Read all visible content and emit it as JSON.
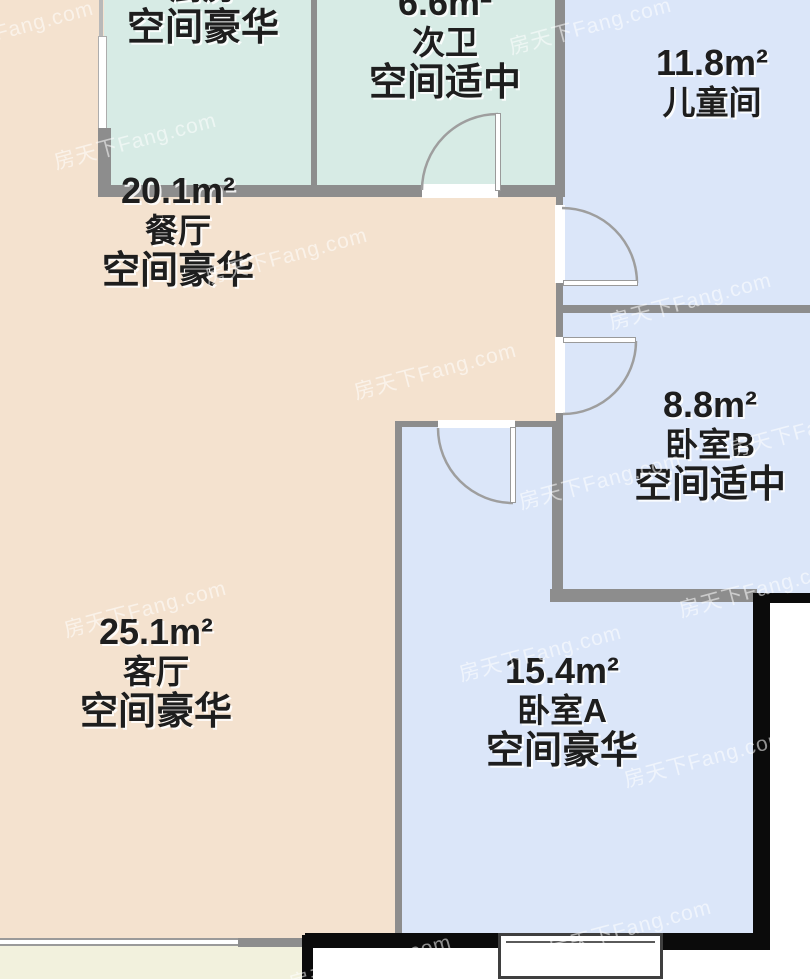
{
  "watermark": {
    "text": "房天下Fang.com"
  },
  "rooms": [
    {
      "id": "kitchen",
      "area": "",
      "name": "厨房",
      "quality": "空间豪华",
      "color": "#d7ebe5"
    },
    {
      "id": "bath2",
      "area": "6.6m²",
      "name": "次卫",
      "quality": "空间适中",
      "color": "#d7ebe5"
    },
    {
      "id": "kids-room",
      "area": "11.8m²",
      "name": "儿童间",
      "quality": "",
      "color": "#dbe6f9"
    },
    {
      "id": "dining",
      "area": "20.1m²",
      "name": "餐厅",
      "quality": "空间豪华",
      "color": "#f4e2cf"
    },
    {
      "id": "bedroom-b",
      "area": "8.8m²",
      "name": "卧室B",
      "quality": "空间适中",
      "color": "#dbe6f9"
    },
    {
      "id": "living",
      "area": "25.1m²",
      "name": "客厅",
      "quality": "空间豪华",
      "color": "#f4e2cf"
    },
    {
      "id": "bedroom-a",
      "area": "15.4m²",
      "name": "卧室A",
      "quality": "空间豪华",
      "color": "#dbe6f9"
    }
  ],
  "palette": {
    "beige_living_dining": "#f4e2cf",
    "teal_kitchen_bath": "#d7ebe5",
    "blue_bedrooms": "#dbe6f9",
    "balcony_pale": "#f2f1dd",
    "wall_gray": "#8d8d8d",
    "wall_black": "#0b0b0b",
    "text": "#1e1e1e"
  }
}
